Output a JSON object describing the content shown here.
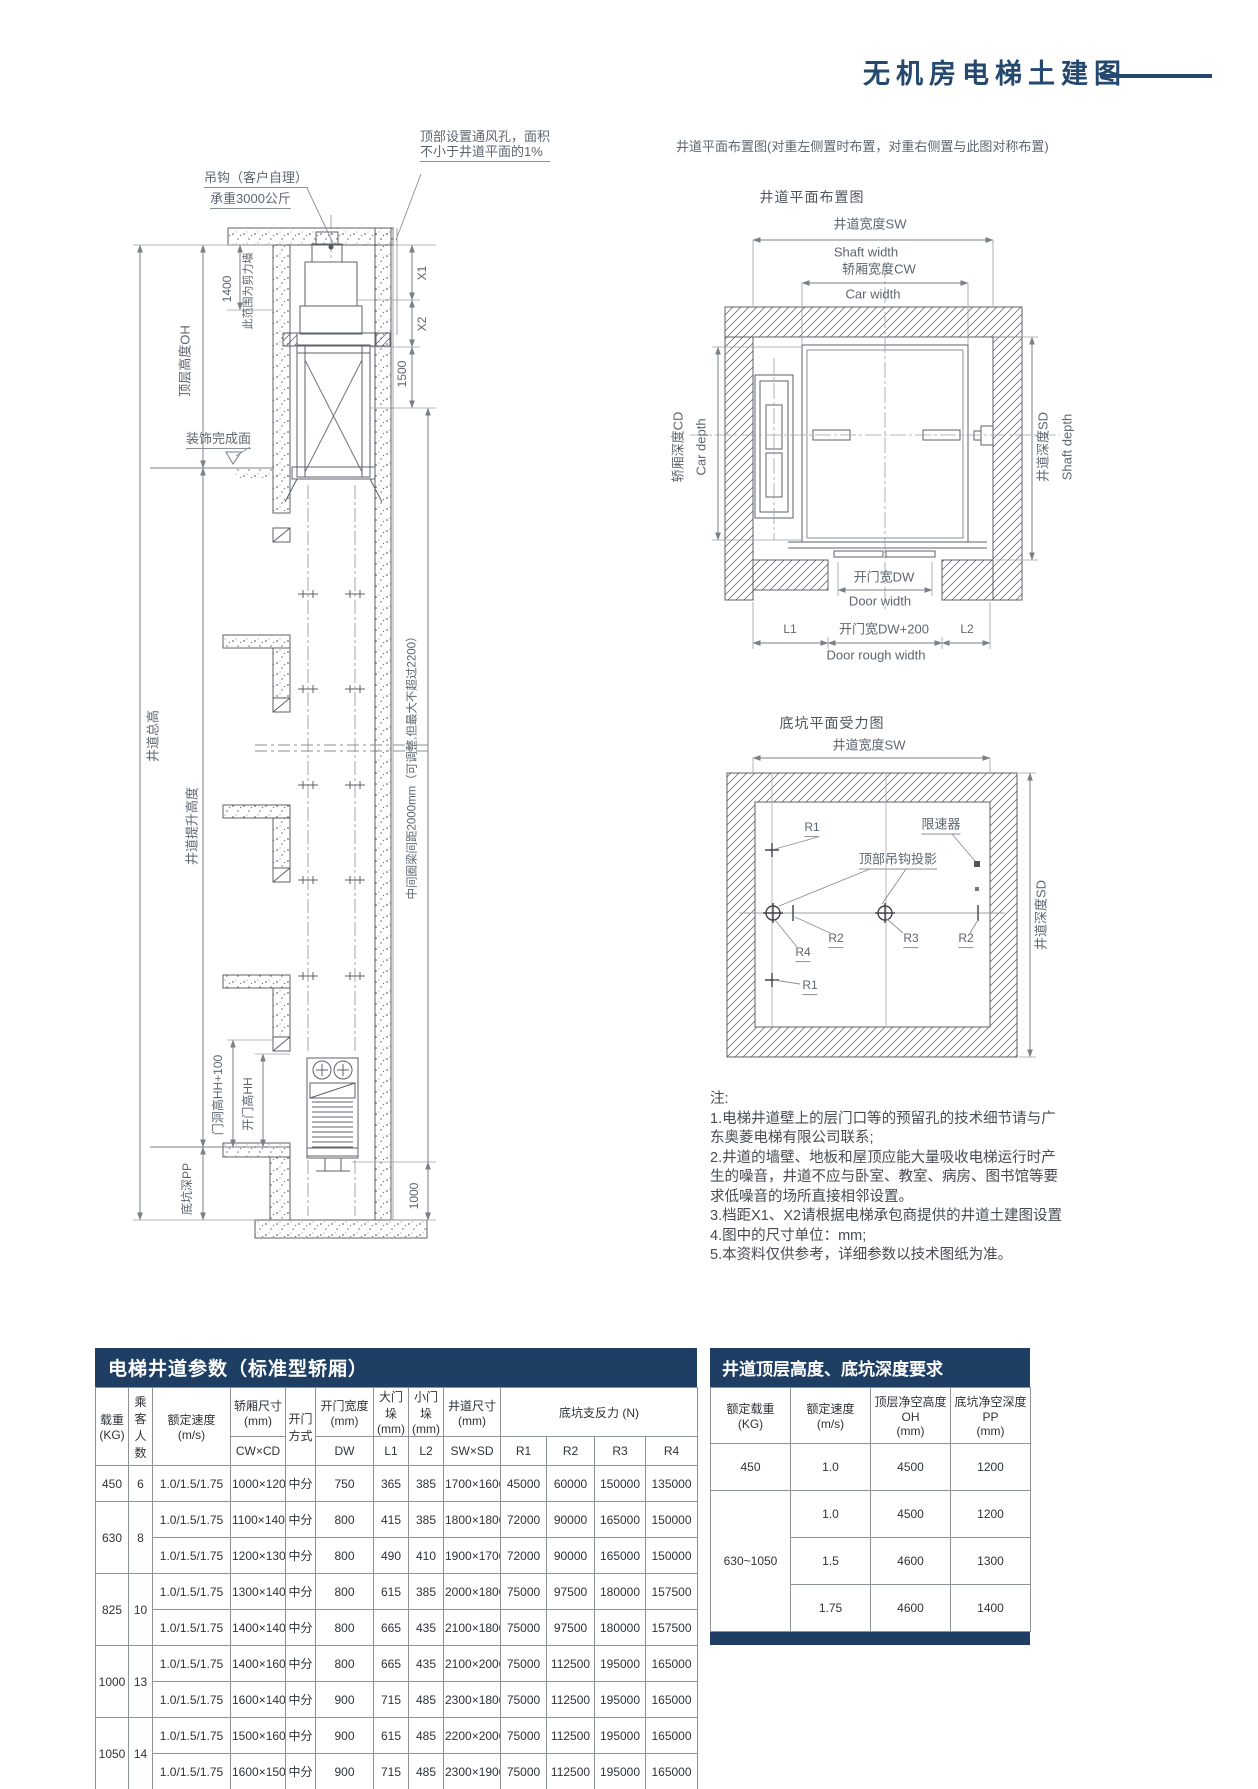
{
  "title": {
    "text": "无机房电梯土建图"
  },
  "section": {
    "vent_note1": "顶部设置通风孔，面积",
    "vent_note2": "不小于井道平面的1%",
    "hook_note1": "吊钩（客户自理）",
    "hook_note2": "承重3000公斤",
    "dim_1400": "1400",
    "shear_wall": "此范围为剪力墙",
    "top_floor_height": "顶层高度OH",
    "decor_surface": "装饰完成面",
    "shaft_total_height": "井道总高",
    "travel_height": "井道提升高度",
    "x1": "X1",
    "x2": "X2",
    "dim_1500": "1500",
    "ring_beam": "中间圈梁间距2000mm（可调整,但最大不超过2200）",
    "door_opening_height": "门洞高HH+100",
    "door_height": "开门高HH",
    "pit_depth": "底坑深PP",
    "dim_1000": "1000"
  },
  "plan": {
    "note": "井道平面布置图(对重左侧置时布置，对重右侧置与此图对称布置)",
    "title": "井道平面布置图",
    "sw_cn": "井道宽度SW",
    "sw_en": "Shaft width",
    "cw_cn": "轿厢宽度CW",
    "cw_en": "Car width",
    "cd_cn": "轿厢深度CD",
    "cd_en": "Car depth",
    "sd_cn": "井道深度SD",
    "sd_en": "Shaft depth",
    "dw_cn": "开门宽DW",
    "dw_en": "Door width",
    "l1": "L1",
    "dw200": "开门宽DW+200",
    "l2": "L2",
    "door_rough": "Door rough width"
  },
  "pit": {
    "title": "底坑平面受力图",
    "sw": "井道宽度SW",
    "sd": "井道深度SD",
    "governor": "限速器",
    "hook_proj": "顶部吊钩投影",
    "r1_upper": "R1",
    "r1_lower": "R1",
    "r2_left": "R2",
    "r2_right": "R2",
    "r3": "R3",
    "r4": "R4"
  },
  "notes": {
    "heading": "注:",
    "lines": [
      "1.电梯井道壁上的层门口等的预留孔的技术细节请与广",
      "东奥菱电梯有限公司联系;",
      "2.井道的墙壁、地板和屋顶应能大量吸收电梯运行时产",
      "生的噪音，井道不应与卧室、教室、病房、图书馆等要",
      "求低噪音的场所直接相邻设置。",
      "3.档距X1、X2请根据电梯承包商提供的井道土建图设置",
      "4.图中的尺寸单位：mm;",
      "5.本资料仅供参考，详细参数以技术图纸为准。"
    ]
  },
  "param_table": {
    "title": "电梯井道参数（标准型轿厢）",
    "h_load1": "载重",
    "h_load2": "(KG)",
    "h_pax1": "乘客",
    "h_pax2": "人数",
    "h_speed1": "额定速度",
    "h_speed2": "(m/s)",
    "h_car1": "轿厢尺寸",
    "h_car2": "(mm)",
    "h_car3": "CW×CD",
    "h_open1": "开门",
    "h_open2": "方式",
    "h_dw1": "开门宽度",
    "h_dw2": "(mm)",
    "h_dw3": "DW",
    "h_l1a": "大门垛",
    "h_l1b": "(mm)",
    "h_l1c": "L1",
    "h_l2a": "小门垛",
    "h_l2b": "(mm)",
    "h_l2c": "L2",
    "h_shaft1": "井道尺寸",
    "h_shaft2": "(mm)",
    "h_shaft3": "SW×SD",
    "h_force": "底坑支反力 (N)",
    "h_r1": "R1",
    "h_r2": "R2",
    "h_r3": "R3",
    "h_r4": "R4",
    "rows": [
      {
        "lead": [
          {
            "t": "450",
            "rs": 1
          },
          {
            "t": "6",
            "rs": 1
          }
        ],
        "cells": [
          "1.0/1.5/1.75",
          "1000×1200",
          "中分",
          "750",
          "365",
          "385",
          "1700×1600",
          "45000",
          "60000",
          "150000",
          "135000"
        ]
      },
      {
        "lead": [
          {
            "t": "630",
            "rs": 2
          },
          {
            "t": "8",
            "rs": 2
          }
        ],
        "cells": [
          "1.0/1.5/1.75",
          "1100×1400",
          "中分",
          "800",
          "415",
          "385",
          "1800×1800",
          "72000",
          "90000",
          "165000",
          "150000"
        ]
      },
      {
        "cells": [
          "1.0/1.5/1.75",
          "1200×1300",
          "中分",
          "800",
          "490",
          "410",
          "1900×1700",
          "72000",
          "90000",
          "165000",
          "150000"
        ]
      },
      {
        "lead": [
          {
            "t": "825",
            "rs": 2
          },
          {
            "t": "10",
            "rs": 2
          }
        ],
        "cells": [
          "1.0/1.5/1.75",
          "1300×1400",
          "中分",
          "800",
          "615",
          "385",
          "2000×1800",
          "75000",
          "97500",
          "180000",
          "157500"
        ]
      },
      {
        "cells": [
          "1.0/1.5/1.75",
          "1400×1400",
          "中分",
          "800",
          "665",
          "435",
          "2100×1800",
          "75000",
          "97500",
          "180000",
          "157500"
        ]
      },
      {
        "lead": [
          {
            "t": "1000",
            "rs": 2
          },
          {
            "t": "13",
            "rs": 2
          }
        ],
        "cells": [
          "1.0/1.5/1.75",
          "1400×1600",
          "中分",
          "800",
          "665",
          "435",
          "2100×2000",
          "75000",
          "112500",
          "195000",
          "165000"
        ]
      },
      {
        "cells": [
          "1.0/1.5/1.75",
          "1600×1400",
          "中分",
          "900",
          "715",
          "485",
          "2300×1800",
          "75000",
          "112500",
          "195000",
          "165000"
        ]
      },
      {
        "lead": [
          {
            "t": "1050",
            "rs": 2
          },
          {
            "t": "14",
            "rs": 2
          }
        ],
        "cells": [
          "1.0/1.5/1.75",
          "1500×1600",
          "中分",
          "900",
          "615",
          "485",
          "2200×2000",
          "75000",
          "112500",
          "195000",
          "165000"
        ]
      },
      {
        "cells": [
          "1.0/1.5/1.75",
          "1600×1500",
          "中分",
          "900",
          "715",
          "485",
          "2300×1900",
          "75000",
          "112500",
          "195000",
          "165000"
        ]
      }
    ]
  },
  "height_table": {
    "title": "井道顶层高度、底坑深度要求",
    "h_load1": "额定载重",
    "h_load2": "(KG)",
    "h_speed1": "额定速度",
    "h_speed2": "(m/s)",
    "h_oh1": "顶层净空高度OH",
    "h_oh2": "(mm)",
    "h_pp1": "底坑净空深度PP",
    "h_pp2": "(mm)",
    "rows": [
      {
        "lead": [
          {
            "t": "450",
            "rs": 1
          }
        ],
        "cells": [
          "1.0",
          "4500",
          "1200"
        ]
      },
      {
        "lead": [
          {
            "t": "630~1050",
            "rs": 3
          }
        ],
        "cells": [
          "1.0",
          "4500",
          "1200"
        ]
      },
      {
        "cells": [
          "1.5",
          "4600",
          "1300"
        ]
      },
      {
        "cells": [
          "1.75",
          "4600",
          "1400"
        ]
      }
    ]
  }
}
